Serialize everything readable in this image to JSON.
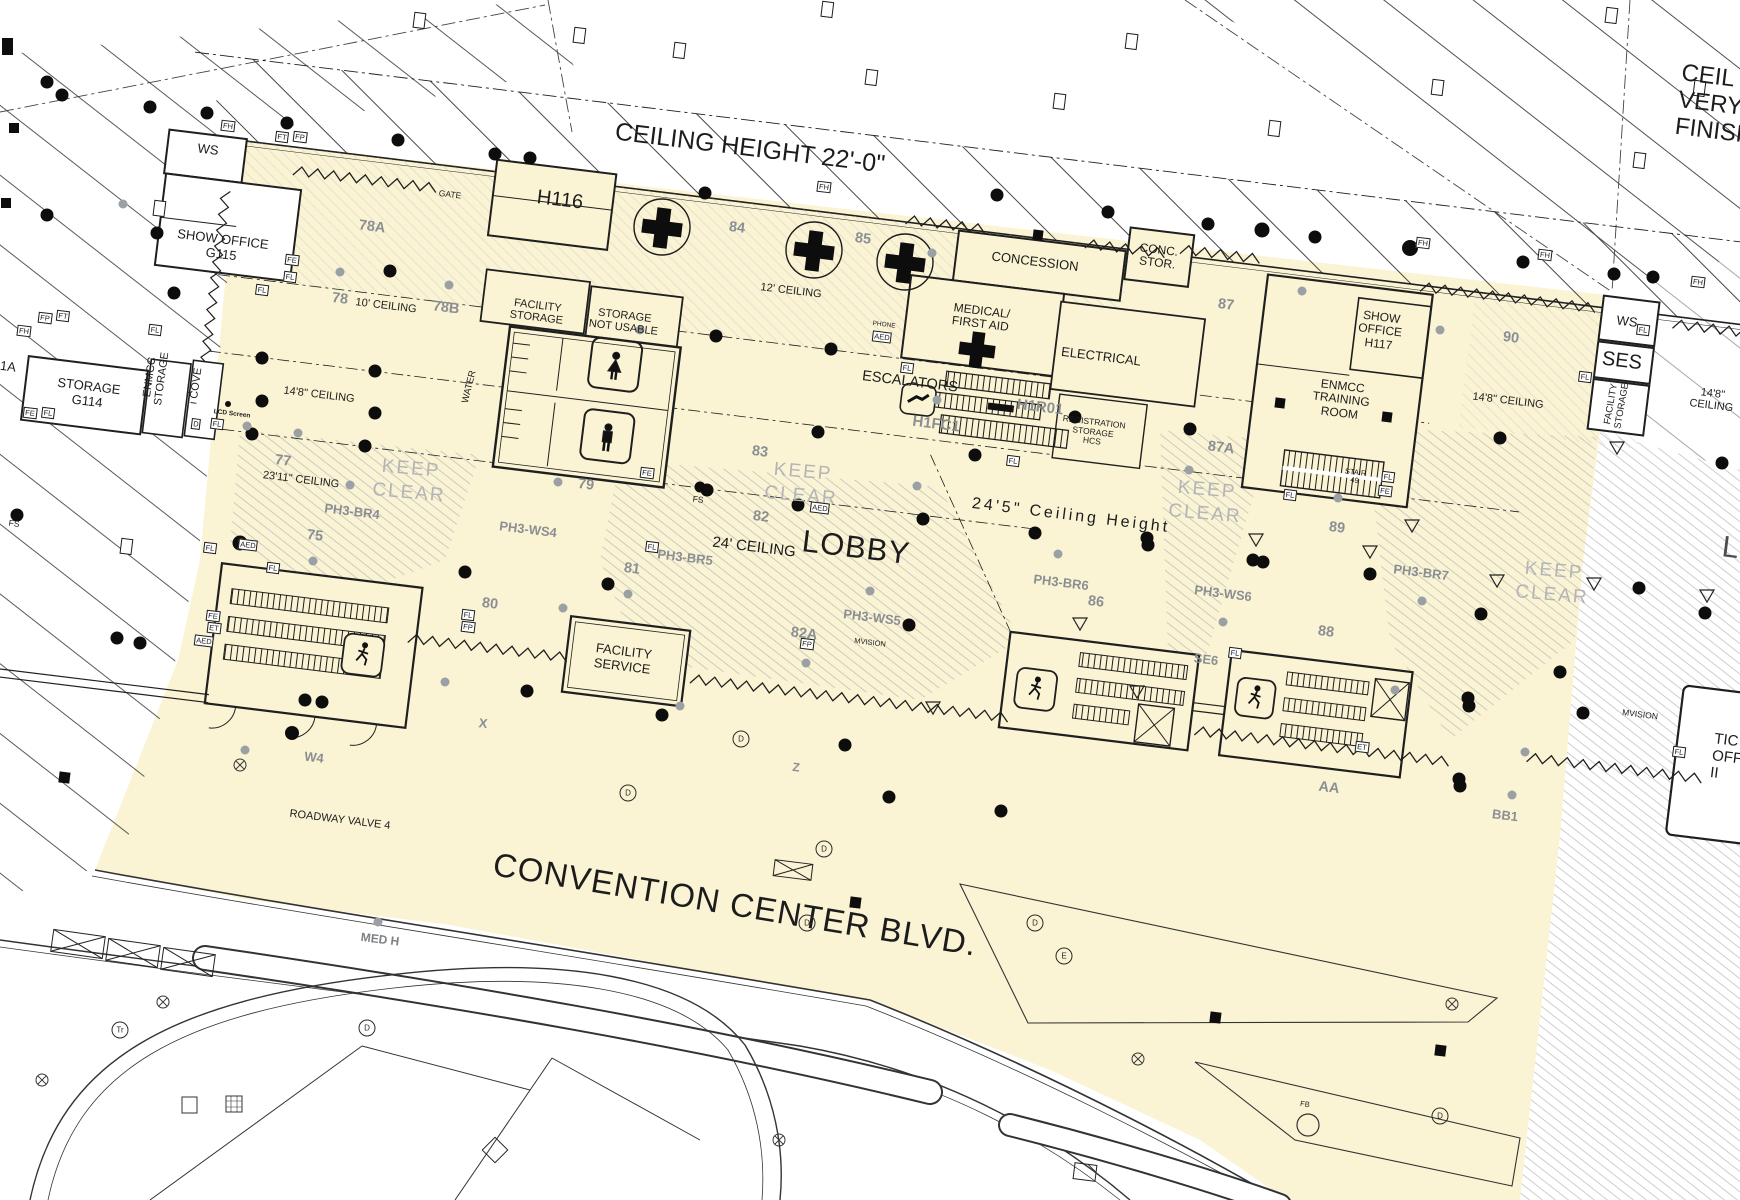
{
  "drawing": {
    "type": "convention center lobby floor plan",
    "highlight_color": "#FAF4D4",
    "street": "CONVENTION CENTER BLVD.",
    "main_area": "LOBBY"
  },
  "labels": {
    "ceiling_height": "CEILING HEIGHT 22'-0\"",
    "ceil_cut": "CEIL\nVERY\nFINISH",
    "ws": "WS",
    "show_office_g115": "SHOW OFFICE\nG115",
    "gate": "GATE",
    "h116": "H116",
    "area_78a": "78A",
    "area_78": "78",
    "area_78b": "78B",
    "ceiling_10": "10' CEILING",
    "facility_storage": "FACILITY\nSTORAGE",
    "storage_not_usable": "STORAGE\nNOT USABLE",
    "area_84": "84",
    "area_85": "85",
    "ceiling_12": "12' CEILING",
    "concession": "CONCESSION",
    "conc_stor": "CONC.\nSTOR.",
    "medical_first_aid": "MEDICAL/\nFIRST AID",
    "electrical": "ELECTRICAL",
    "phone": "PHONE",
    "escalators": "ESCALATORS",
    "h1fc1": "H1FC1",
    "h1r01": "H1R01",
    "registration_storage": "REGISTRATION\nSTORAGE\nHCS",
    "area_87": "87",
    "area_87a": "87A",
    "show_office_h117": "SHOW\nOFFICE\nH117",
    "enmcc_training_room": "ENMCC\nTRAINING\nROOM",
    "stair_49": "STAIR\n49",
    "area_90": "90",
    "ses": "SES",
    "ceiling_14_8": "14'8\" CEILING",
    "storage_g114": "STORAGE\nG114",
    "enmcc_storage": "ENMCC\nSTORAGE",
    "i_cove": "i COVE",
    "area_1a": "1A",
    "water": "WATER",
    "lcd_screen": "LCD Screen",
    "area_77": "77",
    "ceiling_23_11": "23'11\" CEILING",
    "keep_clear": "KEEP\nCLEAR",
    "ph3_br4": "PH3-BR4",
    "ph3_ws4": "PH3-WS4",
    "ph3_br5": "PH3-BR5",
    "ph3_ws5": "PH3-WS5",
    "ph3_br6": "PH3-BR6",
    "ph3_ws6": "PH3-WS6",
    "ph3_br7": "PH3-BR7",
    "area_75": "75",
    "area_79": "79",
    "area_80": "80",
    "area_81": "81",
    "area_82": "82",
    "area_82a": "82A",
    "area_83": "83",
    "area_86": "86",
    "area_88": "88",
    "area_89": "89",
    "fs": "FS",
    "lobby": "LOBBY",
    "ceiling_24": "24' CEILING",
    "ceiling_24_5": "24'5\"  Ceiling  Height",
    "facility_service": "FACILITY\nSERVICE",
    "se6": "SE6",
    "area_aa": "AA",
    "area_bb1": "BB1",
    "area_w4": "W4",
    "roadway_valve_4": "ROADWAY VALVE 4",
    "marker_x": "X",
    "marker_z": "Z",
    "mvision": "MVISION",
    "street": "CONVENTION CENTER BLVD.",
    "med_h": "MED H",
    "ticket_cut": "TIC\nOFF\nII",
    "l_cut": "L"
  },
  "tags": {
    "fl": "FL",
    "fe": "FE",
    "fh": "FH",
    "fp": "FP",
    "ft": "FT",
    "et": "ET",
    "aed": "AED",
    "fb": "FB",
    "d": "D",
    "e": "E",
    "tr": "Tr"
  }
}
